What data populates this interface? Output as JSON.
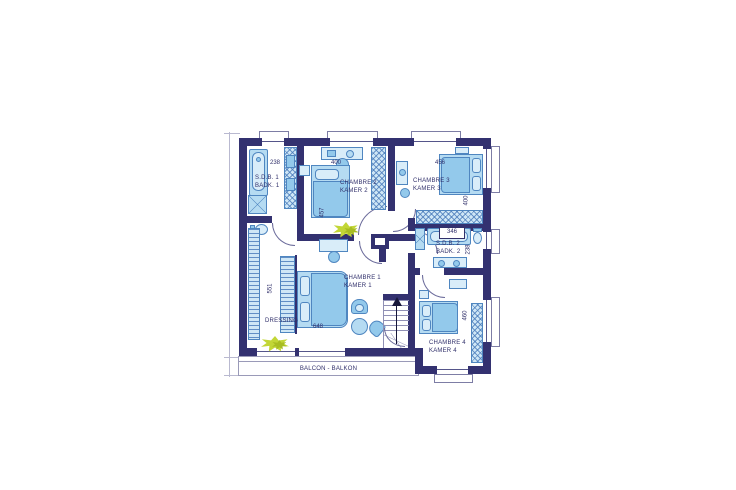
{
  "plan": {
    "type": "architectural-floor-plan",
    "floor": "upper floor (bedrooms)",
    "language": "French / Dutch bilingual"
  },
  "colors": {
    "wall": "#333170",
    "furniture_fill": "#b5dbf2",
    "furniture_edge": "#4f86c0",
    "plant_green": "#c2d636",
    "label_text": "#31306b",
    "background": "#ffffff"
  },
  "labels": {
    "sdb1": {
      "l1": "S.D.B. 1",
      "l2": "BADK. 1"
    },
    "ch2": {
      "l1": "CHAMBRE 2",
      "l2": "KAMER 2"
    },
    "ch3": {
      "l1": "CHAMBRE 3",
      "l2": "KAMER 3"
    },
    "sdb2": {
      "l1": "S.D.B. 2",
      "l2": "BADK. 2"
    },
    "ch1": {
      "l1": "CHAMBRE 1",
      "l2": "KAMER 1"
    },
    "ch4": {
      "l1": "CHAMBRE 4",
      "l2": "KAMER 4"
    },
    "dressing": "DRESSING",
    "balcony": "BALCON - BALKON"
  },
  "dims": {
    "sdb1_w": "238",
    "ch2_w": "400",
    "ch2_d": "457",
    "ch3_w": "456",
    "ch3_d": "400",
    "sdb2_w": "346",
    "sdb2_d": "238",
    "ch1_d": "551",
    "ch1_w": "648",
    "ch4_d": "460"
  }
}
